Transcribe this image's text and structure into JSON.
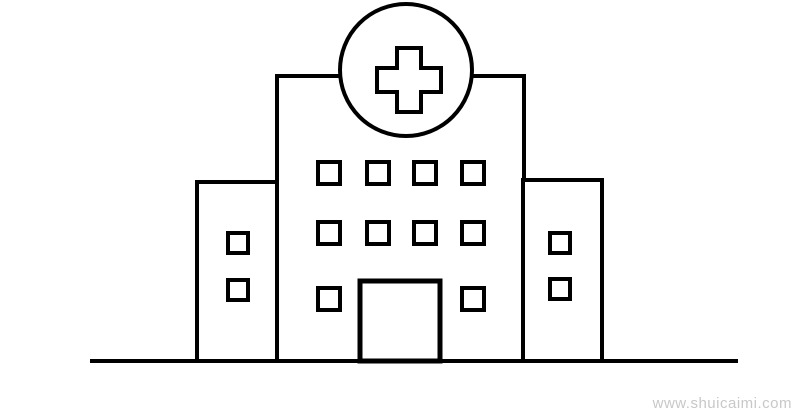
{
  "canvas": {
    "width": 800,
    "height": 416,
    "background": "#ffffff",
    "line_color": "#000000",
    "fill_color": "#ffffff"
  },
  "drawing": {
    "subject": "hospital-line-drawing",
    "ground_line": {
      "x1": 90,
      "y1": 361,
      "x2": 738,
      "y2": 361,
      "stroke_width": 4
    },
    "main_building": {
      "x": 277,
      "y": 76,
      "width": 247,
      "height": 285,
      "stroke_width": 4
    },
    "left_wing": {
      "x": 197,
      "y": 182,
      "width": 80,
      "height": 179,
      "stroke_width": 4
    },
    "right_wing": {
      "x": 523,
      "y": 180,
      "width": 79,
      "height": 181,
      "stroke_width": 4
    },
    "circle": {
      "cx": 406,
      "cy": 70,
      "r": 66,
      "stroke_width": 4
    },
    "cross": {
      "cx": 409,
      "cy": 80,
      "width": 64,
      "height": 64,
      "thickness": 24,
      "stroke_width": 4
    },
    "door": {
      "x": 360,
      "y": 281,
      "width": 80,
      "height": 80,
      "stroke_width": 5
    },
    "main_windows": {
      "size": 22,
      "stroke_width": 4,
      "positions": [
        [
          318,
          162
        ],
        [
          367,
          162
        ],
        [
          414,
          162
        ],
        [
          462,
          162
        ],
        [
          318,
          222
        ],
        [
          367,
          222
        ],
        [
          414,
          222
        ],
        [
          462,
          222
        ],
        [
          318,
          288
        ],
        [
          462,
          288
        ]
      ]
    },
    "wing_windows": {
      "size": 20,
      "stroke_width": 4,
      "positions": [
        [
          228,
          233
        ],
        [
          228,
          280
        ],
        [
          550,
          233
        ],
        [
          550,
          279
        ]
      ]
    }
  },
  "watermark": {
    "text": "www.shuicaimi.com",
    "color": "#c8c8c8",
    "font_size": 15
  }
}
